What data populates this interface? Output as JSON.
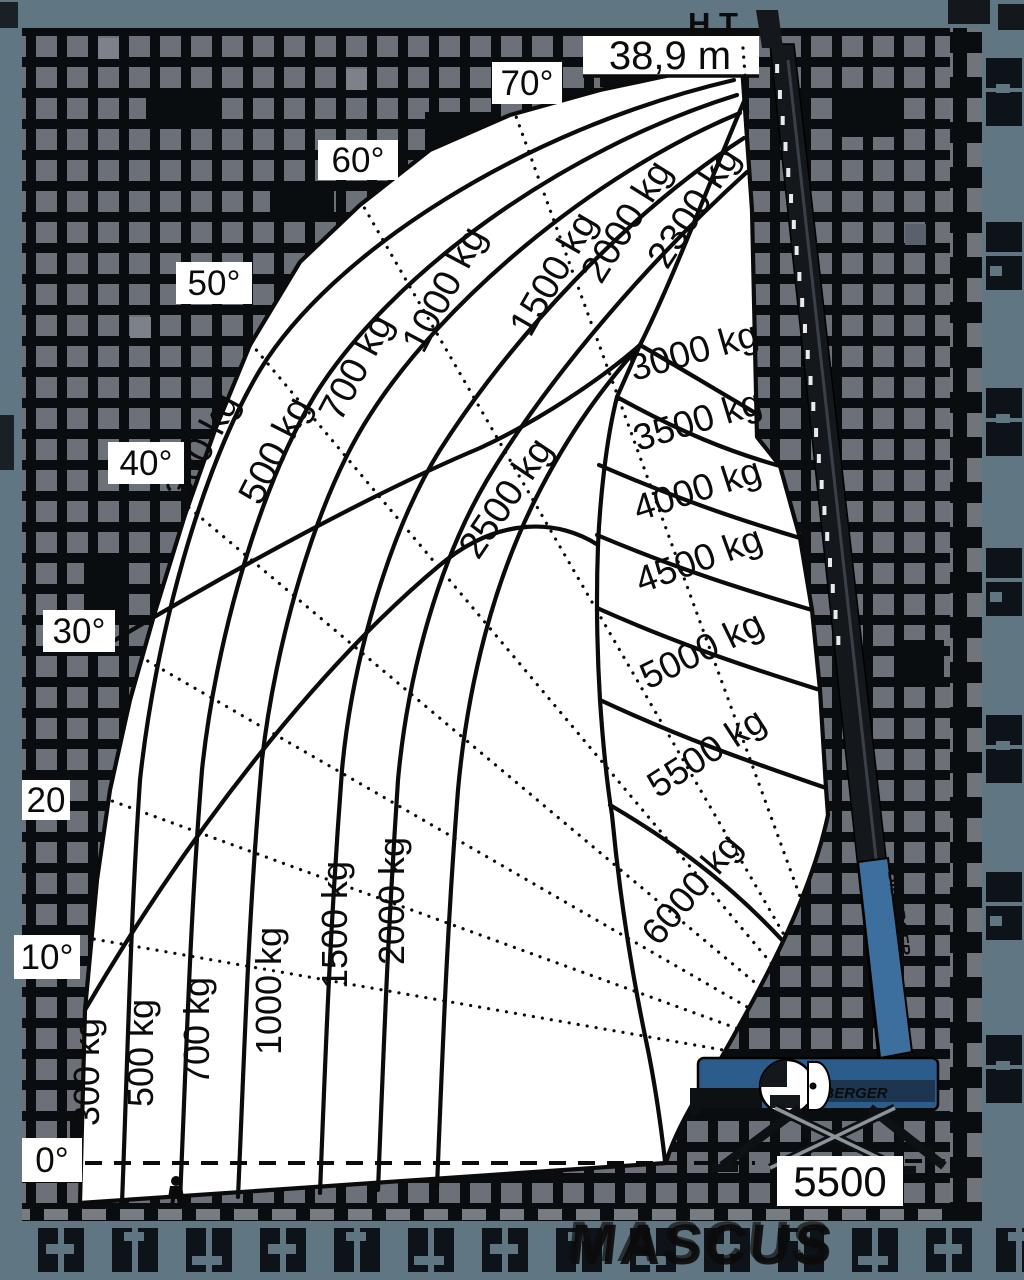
{
  "labels": {
    "header_fragment": "H,T",
    "max_height": "38,9 m",
    "base_dimension": "5500",
    "angles": [
      "70°",
      "60°",
      "50°",
      "40°",
      "30°",
      "20",
      "10°",
      "0°"
    ],
    "loads_lower": [
      "300 kg",
      "500 kg",
      "700 kg",
      "1000 kg",
      "1500 kg",
      "2000 kg"
    ],
    "loads_upper": [
      "300 kg",
      "500 kg",
      "700 kg",
      "1000 kg",
      "1500 kg",
      "2000 kg",
      "2300 kg"
    ],
    "load_mid": "2500 kg",
    "loads_right": [
      "3000 kg",
      "3500 kg",
      "4000 kg",
      "4500 kg",
      "5000 kg",
      "5500 kg",
      "6000 kg"
    ]
  },
  "brand": {
    "boom": "BIBERGER",
    "chassis": "BIBERGER"
  },
  "watermark": {
    "text": "MASCUS"
  },
  "colors": {
    "frame": "#607682",
    "checker_square": "#6c7179",
    "checker_black": "#0a0d10",
    "envelope": "#ffffff",
    "line": "#0b0b0b",
    "machine_blue": "#3c6e9e",
    "machine_dark_blue": "#2c5c8c",
    "mast_dark": "#14181c",
    "watermark_fill": "#222d3a"
  },
  "chart_data": {
    "type": "area",
    "title": "Telescopic crane working range / load capacity diagram",
    "max_height_label": "38,9 m",
    "max_height_m": 38.9,
    "boom_angle_lines_deg": [
      0,
      10,
      20,
      30,
      40,
      50,
      60,
      70
    ],
    "capacity_curves_kg": [
      300,
      500,
      700,
      1000,
      1500,
      2000,
      2300,
      2500,
      3000,
      3500,
      4000,
      4500,
      5000,
      5500,
      6000
    ],
    "support_base_label": "5500",
    "grid": false,
    "legend_position": "labels-on-curves"
  }
}
